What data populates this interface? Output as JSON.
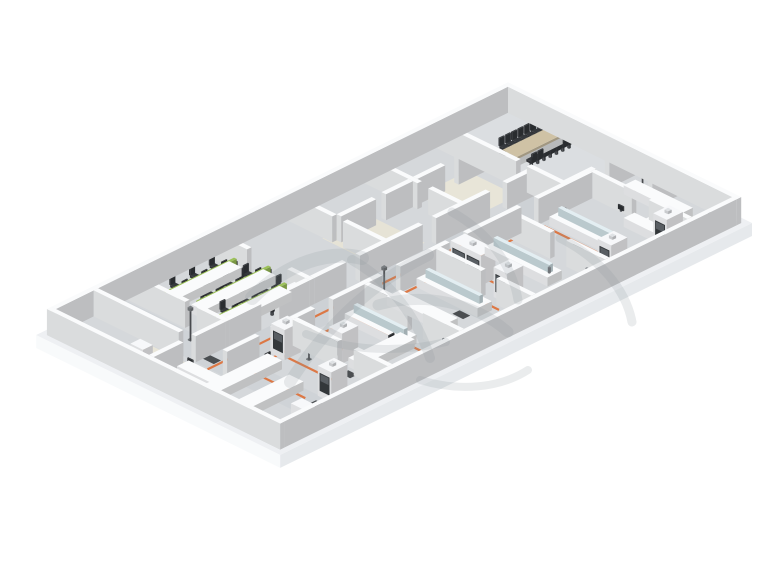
{
  "canvas": {
    "width": 760,
    "height": 570,
    "background": "#ffffff"
  },
  "projection": {
    "a": 0.897,
    "b": 0.441,
    "ox": 508,
    "oy": 103
  },
  "palette": {
    "floor": "#d5d8db",
    "slabTop": "#eef0f3",
    "slabSideLight": "#f8fafb",
    "slabSideDark": "#e6e9ec",
    "wall": "#f2f4f6",
    "wallTop": "#fafbfc",
    "bench": "#f6f7f9",
    "wood": "#cfc2a5",
    "green": "#9cc159",
    "orange": "#dd7038",
    "chair": "#35383c",
    "glass": "#cfdfe4",
    "glassTop": "#e3eef2",
    "mat": "#3f4245",
    "watermark": "#8d939a",
    "carpet": "#e8e5d8",
    "hoodWindow": "#33373a",
    "hoodSash": "#595e63",
    "metal": "#55585c"
  },
  "building": {
    "slab": {
      "u": 0,
      "v": 0,
      "du": 272,
      "dv": 526,
      "thickness": 13
    },
    "floor": {
      "u": 6,
      "v": 6,
      "du": 260,
      "dv": 514
    },
    "wall_height": 26
  },
  "floors": [
    {
      "u": 11,
      "v": 11,
      "du": 137,
      "dv": 75,
      "c": "#dbdee1",
      "n": "conference-room-floor"
    },
    {
      "u": 120,
      "v": 91,
      "du": 30,
      "dv": 346,
      "c": "#cdd1d5",
      "n": "corridor-floor"
    },
    {
      "u": 11,
      "v": 437,
      "du": 250,
      "dv": 31,
      "c": "#cfd3d7",
      "n": "cross-corridor-floor"
    },
    {
      "u": 55,
      "v": 100,
      "du": 55,
      "dv": 55,
      "c": "#e8e5d8",
      "n": "carpet-floor"
    },
    {
      "u": 50,
      "v": 205,
      "du": 62,
      "dv": 52,
      "c": "#e6e3d6",
      "n": "carpet-floor"
    },
    {
      "u": 72,
      "v": 474,
      "du": 48,
      "dv": 38,
      "c": "#e8e5d8",
      "n": "carpet-floor"
    }
  ],
  "walls": [
    [
      6,
      6,
      260,
      5
    ],
    [
      6,
      515,
      260,
      5
    ],
    [
      6,
      11,
      5,
      504
    ],
    [
      261,
      11,
      5,
      504
    ],
    [
      148,
      11,
      5,
      29
    ],
    [
      148,
      55,
      5,
      31
    ],
    [
      11,
      86,
      89,
      5
    ],
    [
      112,
      86,
      41,
      5
    ],
    [
      195,
      11,
      5,
      28
    ],
    [
      153,
      56,
      46,
      5
    ],
    [
      218,
      56,
      43,
      5
    ],
    [
      11,
      166,
      59,
      5
    ],
    [
      82,
      166,
      38,
      5
    ],
    [
      11,
      251,
      49,
      5
    ],
    [
      72,
      251,
      48,
      5
    ],
    [
      11,
      336,
      39,
      5
    ],
    [
      95,
      336,
      25,
      5
    ],
    [
      11,
      430,
      64,
      5
    ],
    [
      88,
      430,
      32,
      5
    ],
    [
      60,
      91,
      5,
      29
    ],
    [
      60,
      135,
      5,
      31
    ],
    [
      60,
      171,
      5,
      30
    ],
    [
      60,
      212,
      5,
      39
    ],
    [
      11,
      468,
      95,
      5
    ],
    [
      115,
      91,
      5,
      30
    ],
    [
      115,
      140,
      5,
      60
    ],
    [
      115,
      215,
      5,
      70
    ],
    [
      115,
      300,
      5,
      36
    ],
    [
      115,
      341,
      5,
      34
    ],
    [
      115,
      395,
      5,
      35
    ],
    [
      115,
      435,
      5,
      33
    ],
    [
      115,
      482,
      5,
      33
    ],
    [
      150,
      61,
      5,
      60
    ],
    [
      150,
      140,
      5,
      60
    ],
    [
      150,
      220,
      5,
      55
    ],
    [
      150,
      295,
      5,
      55
    ],
    [
      150,
      370,
      5,
      45
    ],
    [
      150,
      432,
      5,
      36
    ],
    [
      155,
      148,
      45,
      5
    ],
    [
      218,
      148,
      43,
      5
    ],
    [
      155,
      230,
      50,
      5
    ],
    [
      222,
      230,
      39,
      5
    ],
    [
      155,
      310,
      48,
      5
    ],
    [
      220,
      310,
      41,
      5
    ],
    [
      155,
      390,
      50,
      5
    ],
    [
      223,
      390,
      38,
      5
    ]
  ],
  "furniture": [
    {
      "t": "box",
      "u": 63,
      "v": 16,
      "du": 14,
      "dv": 50,
      "z": 0,
      "h": 8,
      "c": "#eceef0",
      "n": "conference-table-base"
    },
    {
      "t": "box",
      "u": 62,
      "v": 14,
      "du": 16,
      "dv": 54,
      "z": 8,
      "h": 2.5,
      "c": "wood",
      "n": "conference-table-top"
    },
    {
      "t": "chair",
      "u": 55,
      "v": 17,
      "dir": "pu",
      "n": "conference-chair"
    },
    {
      "t": "chair",
      "u": 55,
      "v": 24,
      "dir": "pu",
      "n": "conference-chair"
    },
    {
      "t": "chair",
      "u": 55,
      "v": 31,
      "dir": "pu",
      "n": "conference-chair"
    },
    {
      "t": "chair",
      "u": 55,
      "v": 38,
      "dir": "pu",
      "n": "conference-chair"
    },
    {
      "t": "chair",
      "u": 55,
      "v": 45,
      "dir": "pu",
      "n": "conference-chair"
    },
    {
      "t": "chair",
      "u": 55,
      "v": 52,
      "dir": "pu",
      "n": "conference-chair"
    },
    {
      "t": "chair",
      "u": 55,
      "v": 59,
      "dir": "pu",
      "n": "conference-chair"
    },
    {
      "t": "chair",
      "u": 85,
      "v": 17,
      "dir": "nu",
      "n": "conference-chair"
    },
    {
      "t": "chair",
      "u": 85,
      "v": 24,
      "dir": "nu",
      "n": "conference-chair"
    },
    {
      "t": "chair",
      "u": 85,
      "v": 31,
      "dir": "nu",
      "n": "conference-chair"
    },
    {
      "t": "chair",
      "u": 85,
      "v": 38,
      "dir": "nu",
      "n": "conference-chair"
    },
    {
      "t": "chair",
      "u": 85,
      "v": 45,
      "dir": "nu",
      "n": "conference-chair"
    },
    {
      "t": "chair",
      "u": 85,
      "v": 52,
      "dir": "nu",
      "n": "conference-chair"
    },
    {
      "t": "chair",
      "u": 85,
      "v": 59,
      "dir": "nu",
      "n": "conference-chair"
    },
    {
      "t": "chair",
      "u": 70,
      "v": 10,
      "dir": "pv",
      "n": "conference-chair"
    },
    {
      "t": "chair",
      "u": 70,
      "v": 73,
      "dir": "nv",
      "n": "conference-chair"
    },
    {
      "t": "bench",
      "u": 168,
      "v": 26,
      "du": 64,
      "dv": 13,
      "n": "wall-counter"
    },
    {
      "t": "bench",
      "u": 218,
      "v": 39,
      "du": 14,
      "dv": 36,
      "n": "wall-counter"
    },
    {
      "t": "box",
      "u": 221,
      "v": 60,
      "du": 8,
      "dv": 6,
      "z": 9,
      "h": 1.5,
      "c": "#26282a",
      "n": "counter-mat"
    },
    {
      "t": "fumehood",
      "u": 240,
      "v": 60,
      "du": 15,
      "dv": 18,
      "win": 1
    },
    {
      "t": "pole",
      "u": 177,
      "v": 27
    },
    {
      "t": "box",
      "u": 238,
      "v": 12,
      "du": 7,
      "dv": 3,
      "z": 0,
      "h": 16,
      "c": "#4d5d72",
      "n": "wall-panel"
    },
    {
      "t": "bench",
      "u": 205,
      "v": 64,
      "du": 50,
      "dv": 12,
      "n": "wall-counter"
    },
    {
      "t": "bench_glass",
      "u": 162,
      "v": 100,
      "du": 70,
      "dv": 16
    },
    {
      "t": "fumehood",
      "u": 238,
      "v": 120,
      "du": 15,
      "dv": 18,
      "win": 1
    },
    {
      "t": "monitor",
      "u": 196,
      "v": 70,
      "dir": "pv"
    },
    {
      "t": "bench_glass",
      "u": 160,
      "v": 170,
      "du": 70,
      "dv": 16
    },
    {
      "t": "fumehood",
      "u": 158,
      "v": 206,
      "du": 34,
      "dv": 16,
      "win": 2
    },
    {
      "t": "bench",
      "u": 245,
      "v": 156,
      "du": 14,
      "dv": 64,
      "n": "wall-counter"
    },
    {
      "t": "fumehood",
      "u": 212,
      "v": 210,
      "du": 15,
      "dv": 18,
      "win": 1
    },
    {
      "t": "monitor",
      "u": 214,
      "v": 176,
      "dir": "pv"
    },
    {
      "t": "bench_glass",
      "u": 158,
      "v": 244,
      "du": 68,
      "dv": 16
    },
    {
      "t": "bench",
      "u": 162,
      "v": 282,
      "du": 64,
      "dv": 15,
      "n": "lab-bench"
    },
    {
      "t": "monitor",
      "u": 184,
      "v": 250,
      "dir": "pv"
    },
    {
      "t": "bench_glass",
      "u": 158,
      "v": 324,
      "du": 64,
      "dv": 16
    },
    {
      "t": "bench",
      "u": 210,
      "v": 330,
      "du": 16,
      "dv": 58,
      "n": "lab-bench"
    },
    {
      "t": "bench",
      "u": 245,
      "v": 316,
      "du": 14,
      "dv": 60,
      "n": "wall-counter"
    },
    {
      "t": "fumehood",
      "u": 188,
      "v": 370,
      "du": 15,
      "dv": 18,
      "win": 1
    },
    {
      "t": "monitor",
      "u": 214,
      "v": 344,
      "dir": "pu"
    },
    {
      "t": "pole",
      "u": 180,
      "v": 402
    },
    {
      "t": "fumehood",
      "u": 152,
      "v": 398,
      "du": 15,
      "dv": 18,
      "win": 1
    },
    {
      "t": "bench",
      "u": 160,
      "v": 428,
      "du": 16,
      "dv": 80,
      "n": "lab-bench"
    },
    {
      "t": "bench",
      "u": 196,
      "v": 440,
      "du": 16,
      "dv": 72,
      "n": "lab-bench"
    },
    {
      "t": "fumehood",
      "u": 226,
      "v": 420,
      "du": 15,
      "dv": 18,
      "win": 1
    },
    {
      "t": "cabinet",
      "u": 240,
      "v": 470,
      "du": 14,
      "dv": 12,
      "h": 18
    },
    {
      "t": "monitor",
      "u": 166,
      "v": 434,
      "dir": "pu"
    },
    {
      "t": "bench",
      "u": 124,
      "v": 480,
      "du": 50,
      "dv": 13,
      "n": "lab-bench"
    },
    {
      "t": "cabinet",
      "u": 85,
      "v": 495,
      "du": 14,
      "dv": 11,
      "h": 20
    },
    {
      "t": "pole",
      "u": 92,
      "v": 446
    },
    {
      "t": "monitor",
      "u": 130,
      "v": 484,
      "dir": "pv"
    },
    {
      "t": "bench",
      "u": 34,
      "v": 345,
      "du": 14,
      "dv": 80,
      "n": "office-desk"
    },
    {
      "t": "box",
      "u": 39.5,
      "v": 345,
      "du": 3,
      "dv": 80,
      "z": 9,
      "h": 6,
      "c": "green",
      "n": "desk-partition"
    },
    {
      "t": "bench",
      "u": 62,
      "v": 335,
      "du": 14,
      "dv": 80,
      "n": "office-desk"
    },
    {
      "t": "box",
      "u": 67.5,
      "v": 335,
      "du": 3,
      "dv": 80,
      "z": 9,
      "h": 6,
      "c": "green",
      "n": "desk-partition"
    },
    {
      "t": "bench",
      "u": 90,
      "v": 345,
      "du": 14,
      "dv": 80,
      "n": "office-desk"
    },
    {
      "t": "box",
      "u": 95.5,
      "v": 345,
      "du": 3,
      "dv": 80,
      "z": 9,
      "h": 6,
      "c": "green",
      "n": "desk-partition"
    },
    {
      "t": "chair",
      "u": 29,
      "v": 356,
      "dir": "pu"
    },
    {
      "t": "chair",
      "u": 29,
      "v": 378,
      "dir": "pu"
    },
    {
      "t": "chair",
      "u": 29,
      "v": 400,
      "dir": "pu"
    },
    {
      "t": "chair",
      "u": 53,
      "v": 350,
      "dir": "nu"
    },
    {
      "t": "chair",
      "u": 53,
      "v": 372,
      "dir": "nu"
    },
    {
      "t": "chair",
      "u": 53,
      "v": 394,
      "dir": "nu"
    },
    {
      "t": "chair",
      "u": 57,
      "v": 346,
      "dir": "pu"
    },
    {
      "t": "chair",
      "u": 57,
      "v": 368,
      "dir": "pu"
    },
    {
      "t": "chair",
      "u": 57,
      "v": 390,
      "dir": "pu"
    },
    {
      "t": "chair",
      "u": 81,
      "v": 340,
      "dir": "nu"
    },
    {
      "t": "chair",
      "u": 81,
      "v": 362,
      "dir": "nu"
    },
    {
      "t": "chair",
      "u": 81,
      "v": 384,
      "dir": "nu"
    },
    {
      "t": "chair",
      "u": 85,
      "v": 356,
      "dir": "pu"
    },
    {
      "t": "chair",
      "u": 85,
      "v": 378,
      "dir": "pu"
    },
    {
      "t": "chair",
      "u": 85,
      "v": 400,
      "dir": "pu"
    },
    {
      "t": "chair",
      "u": 109,
      "v": 350,
      "dir": "nu"
    },
    {
      "t": "chair",
      "u": 109,
      "v": 372,
      "dir": "nu"
    },
    {
      "t": "chair",
      "u": 109,
      "v": 394,
      "dir": "nu"
    },
    {
      "t": "monitor",
      "u": 37.5,
      "v": 354,
      "dir": "nu"
    },
    {
      "t": "monitor",
      "u": 37.5,
      "v": 376,
      "dir": "nu"
    },
    {
      "t": "monitor",
      "u": 37.5,
      "v": 398,
      "dir": "nu"
    },
    {
      "t": "monitor",
      "u": 45,
      "v": 350,
      "dir": "pu"
    },
    {
      "t": "monitor",
      "u": 45,
      "v": 372,
      "dir": "pu"
    },
    {
      "t": "monitor",
      "u": 45,
      "v": 394,
      "dir": "pu"
    },
    {
      "t": "monitor",
      "u": 65.5,
      "v": 344,
      "dir": "nu"
    },
    {
      "t": "monitor",
      "u": 65.5,
      "v": 366,
      "dir": "nu"
    },
    {
      "t": "monitor",
      "u": 65.5,
      "v": 388,
      "dir": "nu"
    },
    {
      "t": "monitor",
      "u": 73,
      "v": 340,
      "dir": "pu"
    },
    {
      "t": "monitor",
      "u": 73,
      "v": 362,
      "dir": "pu"
    },
    {
      "t": "monitor",
      "u": 73,
      "v": 384,
      "dir": "pu"
    },
    {
      "t": "monitor",
      "u": 93.5,
      "v": 354,
      "dir": "nu"
    },
    {
      "t": "monitor",
      "u": 93.5,
      "v": 376,
      "dir": "nu"
    },
    {
      "t": "monitor",
      "u": 93.5,
      "v": 398,
      "dir": "nu"
    },
    {
      "t": "monitor",
      "u": 101,
      "v": 350,
      "dir": "pu"
    },
    {
      "t": "monitor",
      "u": 101,
      "v": 372,
      "dir": "pu"
    },
    {
      "t": "monitor",
      "u": 101,
      "v": 394,
      "dir": "pu"
    },
    {
      "t": "cabinet",
      "u": 100,
      "v": 414,
      "du": 13,
      "dv": 10,
      "h": 18
    },
    {
      "t": "cabinet",
      "u": 102,
      "v": 340,
      "du": 12,
      "dv": 10,
      "h": 16
    },
    {
      "t": "pole",
      "u": 154,
      "v": 292
    },
    {
      "t": "faucet",
      "u": 168,
      "v": 104
    },
    {
      "t": "faucet",
      "u": 226,
      "v": 110
    },
    {
      "t": "faucet",
      "u": 166,
      "v": 174
    },
    {
      "t": "faucet",
      "u": 226,
      "v": 180
    },
    {
      "t": "faucet",
      "u": 162,
      "v": 248
    },
    {
      "t": "faucet",
      "u": 220,
      "v": 252
    },
    {
      "t": "faucet",
      "u": 162,
      "v": 328
    },
    {
      "t": "faucet",
      "u": 216,
      "v": 332
    },
    {
      "t": "faucet",
      "u": 248,
      "v": 160
    },
    {
      "t": "faucet",
      "u": 248,
      "v": 320
    }
  ],
  "mats": [
    {
      "u": 143,
      "v": 182,
      "du": 8,
      "dv": 12
    },
    {
      "u": 143,
      "v": 282,
      "du": 8,
      "dv": 12
    },
    {
      "u": 143,
      "v": 380,
      "du": 8,
      "dv": 12
    },
    {
      "u": 196,
      "v": 120,
      "du": 12,
      "dv": 8
    },
    {
      "u": 208,
      "v": 262,
      "du": 12,
      "dv": 8
    },
    {
      "u": 120,
      "v": 452,
      "du": 12,
      "dv": 8
    },
    {
      "u": 214,
      "v": 392,
      "du": 10,
      "dv": 8
    },
    {
      "u": 230,
      "v": 444,
      "du": 12,
      "dv": 8
    }
  ],
  "utility_lines": [
    {
      "pts": [
        [
          160,
          120
        ],
        [
          250,
          120
        ]
      ]
    },
    {
      "pts": [
        [
          158,
          150
        ],
        [
          158,
          460
        ]
      ]
    },
    {
      "pts": [
        [
          158,
          212
        ],
        [
          248,
          212
        ]
      ]
    },
    {
      "pts": [
        [
          158,
          240
        ],
        [
          230,
          240
        ]
      ]
    },
    {
      "pts": [
        [
          158,
          292
        ],
        [
          246,
          292
        ]
      ]
    },
    {
      "pts": [
        [
          158,
          330
        ],
        [
          242,
          330
        ]
      ]
    },
    {
      "pts": [
        [
          158,
          372
        ],
        [
          236,
          372
        ]
      ]
    },
    {
      "pts": [
        [
          158,
          412
        ],
        [
          230,
          412
        ]
      ]
    },
    {
      "pts": [
        [
          158,
          448
        ],
        [
          222,
          448
        ]
      ]
    },
    {
      "pts": [
        [
          40,
          488
        ],
        [
          150,
          488
        ]
      ]
    },
    {
      "pts": [
        [
          250,
          120
        ],
        [
          250,
          290
        ]
      ]
    },
    {
      "pts": [
        [
          135,
          150
        ],
        [
          135,
          470
        ]
      ]
    }
  ],
  "watermark": {
    "opacity": 0.18,
    "strokes": [
      {
        "d": "M252,298 C288,262 330,250 362,258",
        "w": 14
      },
      {
        "d": "M290,382 C322,332 368,284 428,255",
        "w": 12
      },
      {
        "d": "M352,260 C392,282 418,320 430,358",
        "w": 10
      },
      {
        "d": "M378,305 C424,292 474,302 508,332",
        "w": 11
      },
      {
        "d": "M452,212 C488,232 512,264 518,300",
        "w": 9
      },
      {
        "d": "M560,238 C600,258 626,290 632,322",
        "w": 9
      },
      {
        "d": "M306,334 C346,350 396,354 446,342",
        "w": 8
      },
      {
        "d": "M420,380 C460,392 500,388 528,370",
        "w": 8
      }
    ]
  }
}
